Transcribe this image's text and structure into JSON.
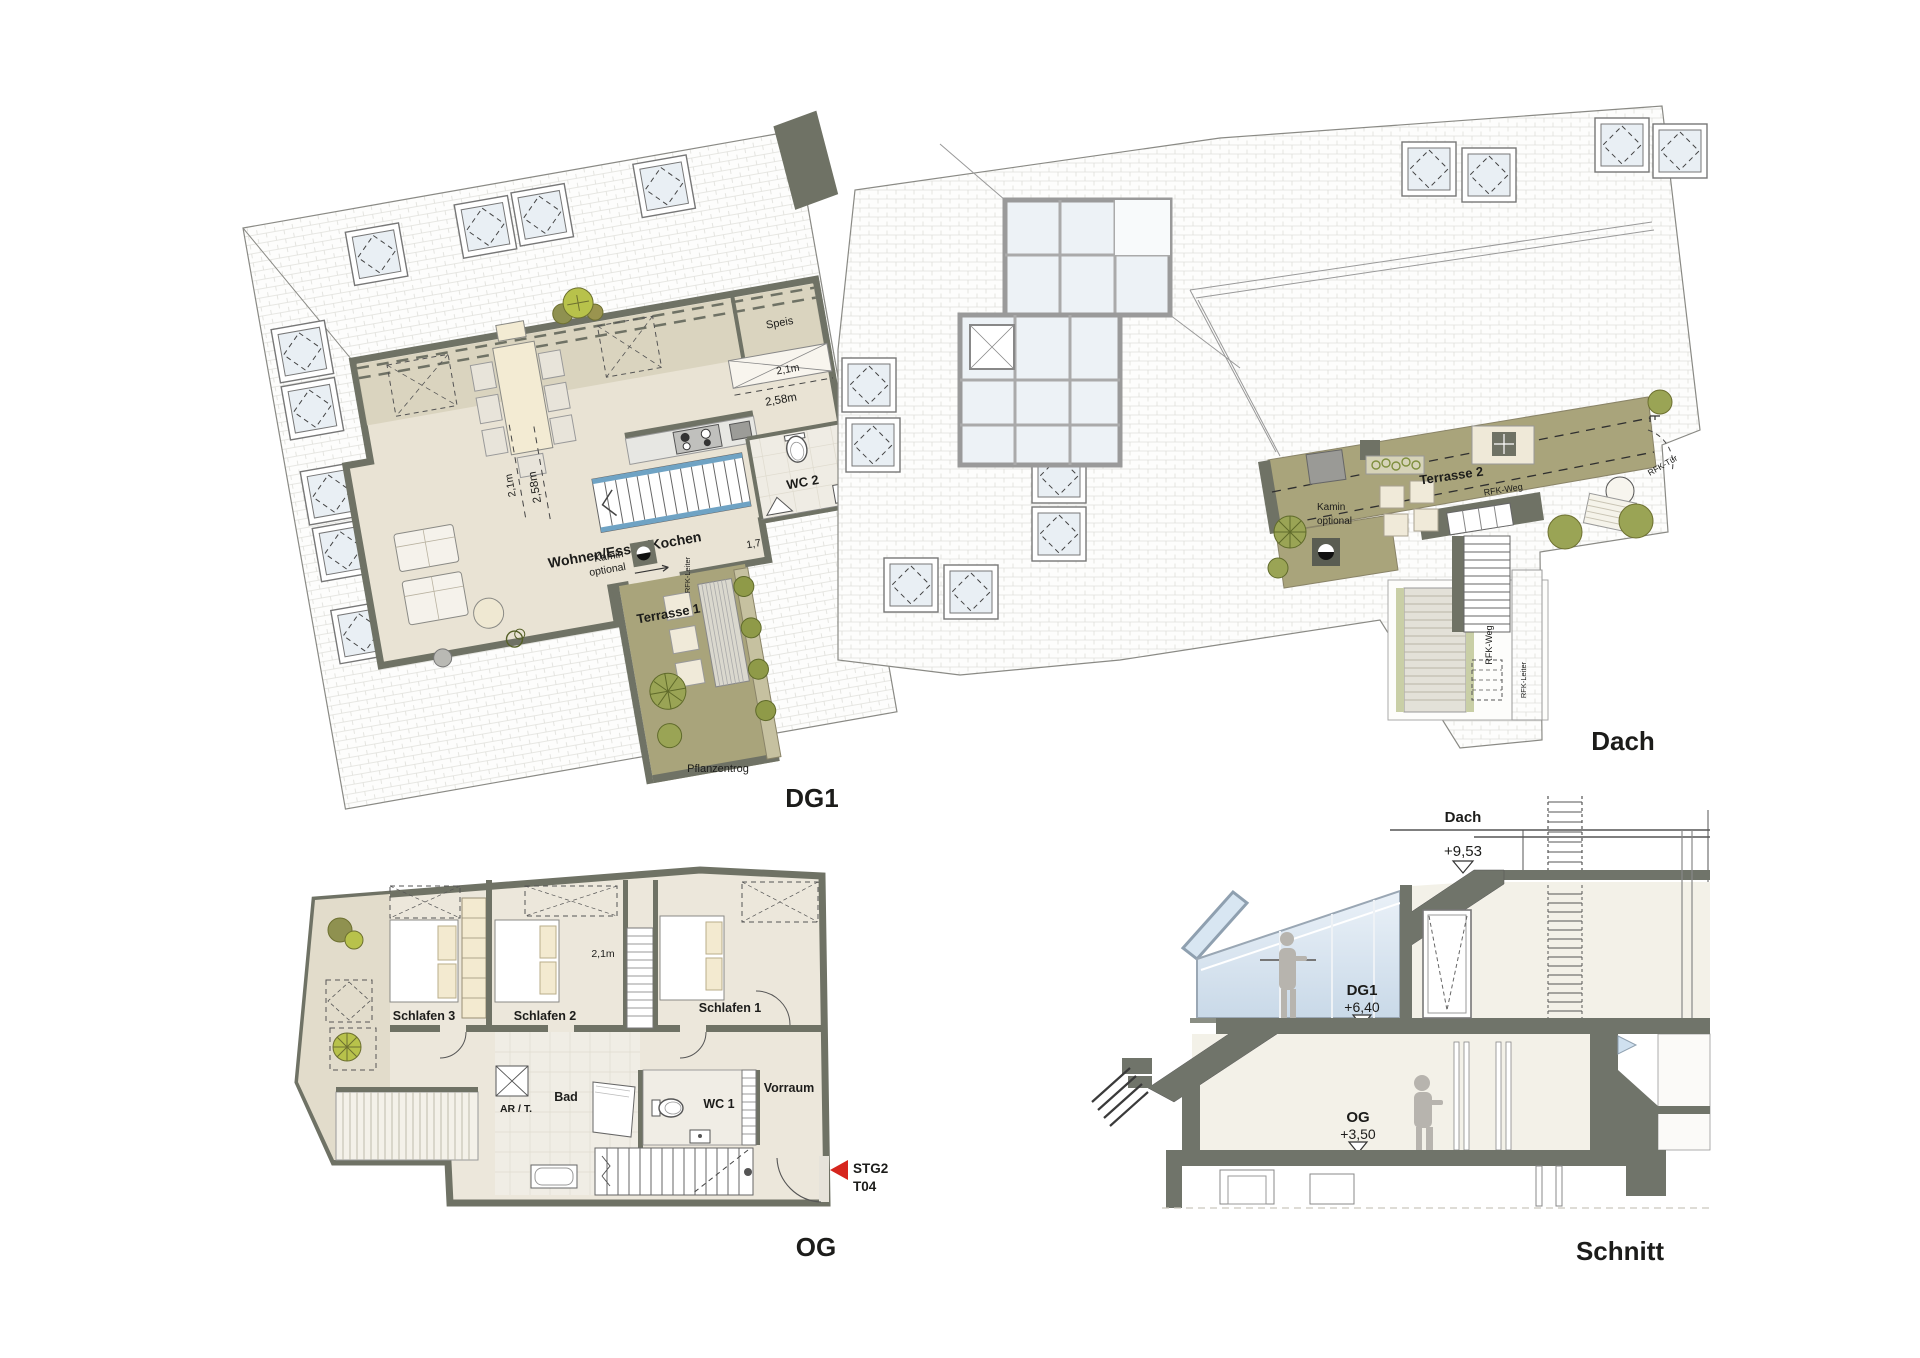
{
  "colors": {
    "wall": "#6f7265",
    "floor": "#e9e3d4",
    "floor_tint": "#d8d1bd",
    "terrace": "#a9a47b",
    "plant_bright": "#b8c24b",
    "plant_olive": "#8f9150",
    "glass": "#dce8f3",
    "stair_blue": "#6fa3c4",
    "tile": "#efece4",
    "marker_red": "#d6251d",
    "text": "#1c1c1a"
  },
  "dg1": {
    "title": "DG1",
    "labels": {
      "room_main": "Wohnen/Essen/Kochen",
      "speis": "Speis",
      "dim_niche": "2,1m",
      "dim_below": "2,58m",
      "dim_v1": "2,1m",
      "dim_v2": "2,58m",
      "wc2": "WC 2",
      "kamin_1": "Kamin",
      "kamin_2": "optional",
      "dim_17": "1,7",
      "terrasse1": "Terrasse 1",
      "pflanzentrog": "Pflanzentrog",
      "rfk_leiter": "RFK-Leiter"
    }
  },
  "dach": {
    "title": "Dach",
    "labels": {
      "terrasse2": "Terrasse 2",
      "rfk_weg_path": "RFK-Weg",
      "rfk_tuer": "RFK-Tür",
      "kamin_1": "Kamin",
      "kamin_2": "optional",
      "rfk_weg_stair": "RFK-Weg",
      "rfk_leiter": "RFK-Leiter"
    }
  },
  "og": {
    "title": "OG",
    "labels": {
      "schlafen3": "Schlafen 3",
      "schlafen2": "Schlafen 2",
      "schlafen1": "Schlafen 1",
      "dim_21": "2,1m",
      "ar_t": "AR / T.",
      "bad": "Bad",
      "wc1": "WC 1",
      "vorraum": "Vorraum",
      "stg2": "STG2",
      "t04": "T04"
    }
  },
  "schnitt": {
    "title": "Schnitt",
    "labels": {
      "dach": "Dach",
      "lvl_dach": "+9,53",
      "dg1": "DG1",
      "lvl_dg1": "+6,40",
      "og": "OG",
      "lvl_og": "+3,50"
    }
  }
}
